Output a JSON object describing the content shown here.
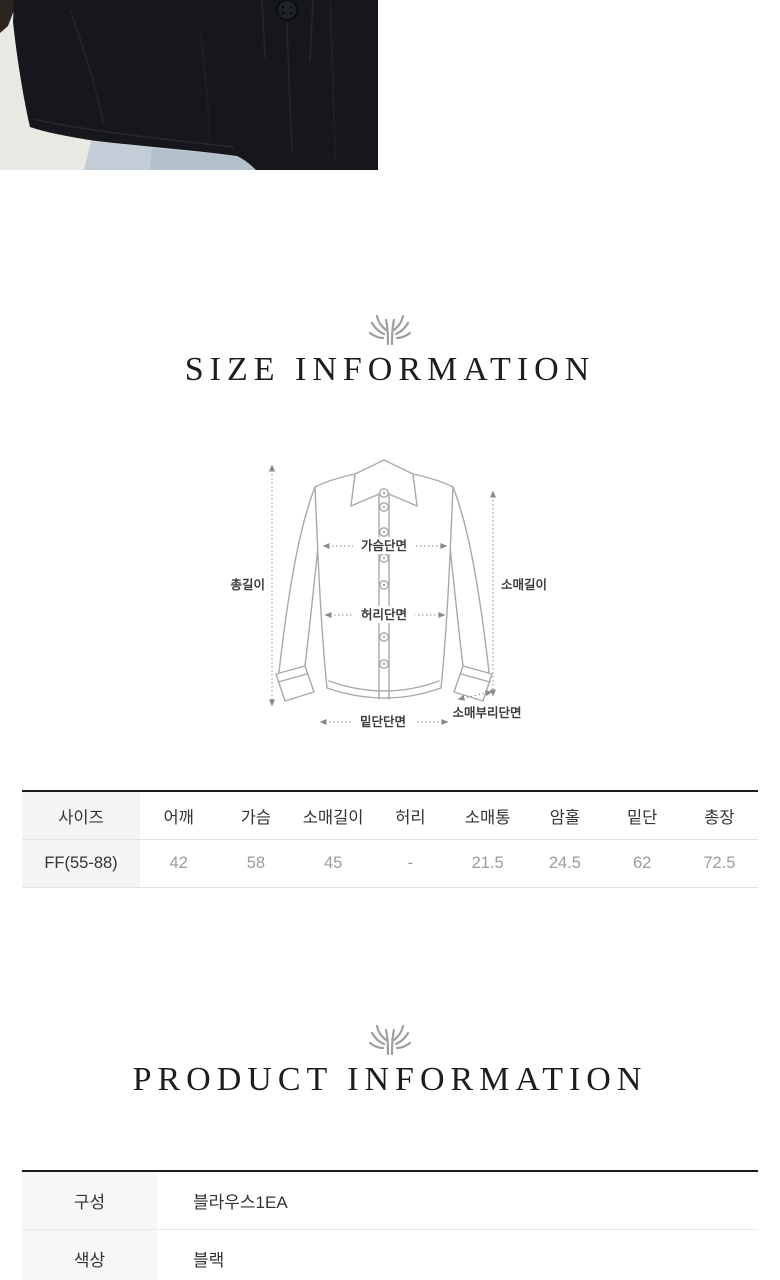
{
  "hero_photo": {
    "name": "black-blouse-hem-photo",
    "wall_color": "#eae8e3",
    "shirt_color": "#16171c",
    "denim_color": "#c2cdd7",
    "button_color": "#20222a"
  },
  "ornament_color": "#9e9e9e",
  "size_section": {
    "title": "SIZE INFORMATION",
    "diagram": {
      "labels": {
        "total_length": "총길이",
        "chest": "가슴단면",
        "waist": "허리단면",
        "hem": "밑단단면",
        "sleeve_length": "소매길이",
        "cuff": "소매부리단면"
      }
    },
    "table": {
      "headers": [
        "사이즈",
        "어깨",
        "가슴",
        "소매길이",
        "허리",
        "소매통",
        "암홀",
        "밑단",
        "총장"
      ],
      "rows": [
        [
          "FF(55-88)",
          "42",
          "58",
          "45",
          "-",
          "21.5",
          "24.5",
          "62",
          "72.5"
        ]
      ]
    }
  },
  "product_section": {
    "title": "PRODUCT INFORMATION",
    "rows": [
      {
        "label": "구성",
        "value": "블라우스1EA"
      },
      {
        "label": "색상",
        "value": "블랙"
      }
    ]
  }
}
